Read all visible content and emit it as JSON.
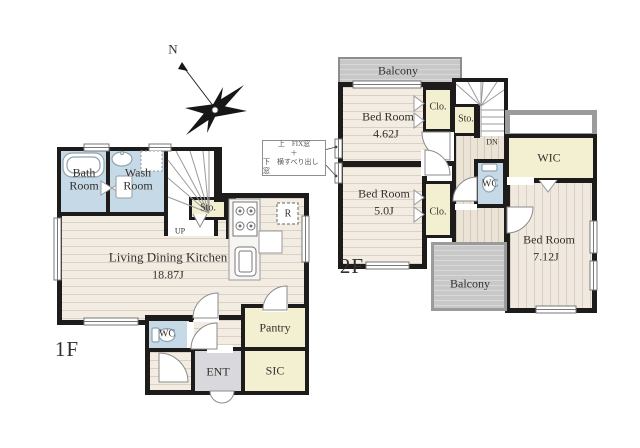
{
  "floor1": {
    "label": "1F",
    "rooms": {
      "bath": "Bath Room",
      "wash": "Wash Room",
      "sto": "Sto.",
      "ldk_name": "Living Dining Kitchen",
      "ldk_size": "18.87J",
      "wc": "WC",
      "ent": "ENT",
      "pantry": "Pantry",
      "sic": "SIC"
    },
    "marks": {
      "up": "UP",
      "fridge": "R"
    }
  },
  "floor2": {
    "label": "2F",
    "rooms": {
      "balcony_top": "Balcony",
      "bed1_name": "Bed Room",
      "bed1_size": "4.62J",
      "clo1": "Clo.",
      "sto": "Sto.",
      "bed2_name": "Bed Room",
      "bed2_size": "5.0J",
      "clo2": "Clo.",
      "wc": "WC",
      "wic": "WIC",
      "bed3_name": "Bed Room",
      "bed3_size": "7.12J",
      "balcony_bottom": "Balcony"
    },
    "marks": {
      "dn": "DN"
    }
  },
  "compass": {
    "north": "N"
  },
  "window_note": {
    "line1": "上　FIX窓",
    "line2": "＋",
    "line3": "下　横すべり出し窓"
  },
  "colors": {
    "wall": "#1d1c1a",
    "wet_room": "#c5d9e7",
    "storage": "#f3f0d2",
    "entrance_floor": "#d9d8dc",
    "balcony": "#c8c8c8",
    "wood_floor": "#f2ece3"
  }
}
